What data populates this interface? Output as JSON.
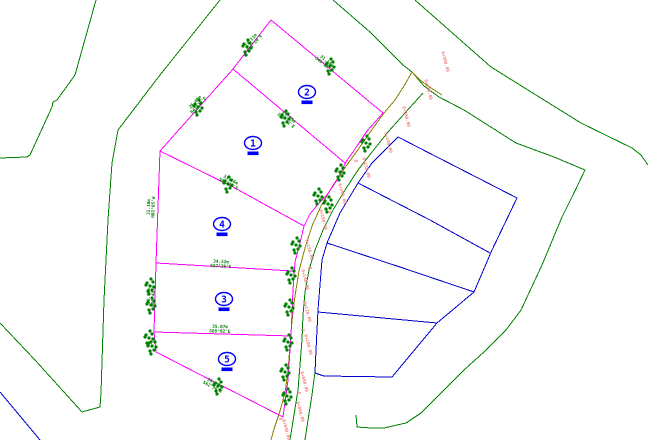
{
  "title": "subdivision-site-plan",
  "colors": {
    "boundary_green": "#008000",
    "parcel_magenta": "#FF00FF",
    "road_olive": "#8B8000",
    "block_blue": "#0000CD",
    "label_blue": "#0000FF",
    "station_red": "#F08080",
    "background": "#FFFFFF"
  },
  "parcel_labels": [
    {
      "number": "2",
      "x": 307,
      "y": 92
    },
    {
      "number": "1",
      "x": 253,
      "y": 143
    },
    {
      "number": "4",
      "x": 222,
      "y": 224
    },
    {
      "number": "3",
      "x": 224,
      "y": 299
    },
    {
      "number": "5",
      "x": 227,
      "y": 359
    }
  ],
  "drawing": {
    "polylines": [
      {
        "name": "contour-line-west",
        "color": "boundary_green",
        "width": 1,
        "points": [
          [
            96,
            0
          ],
          [
            75,
            75
          ],
          [
            57,
            100
          ],
          [
            53,
            102
          ],
          [
            52,
            107
          ],
          [
            30,
            155
          ],
          [
            27,
            157
          ],
          [
            0,
            158
          ]
        ]
      },
      {
        "name": "contour-line-inner",
        "color": "boundary_green",
        "width": 1,
        "points": [
          [
            220,
            0
          ],
          [
            160,
            75
          ],
          [
            118,
            130
          ],
          [
            112,
            163
          ],
          [
            108,
            220
          ],
          [
            104,
            300
          ],
          [
            101,
            393
          ],
          [
            100,
            407
          ],
          [
            82,
            412
          ]
        ]
      },
      {
        "name": "contour-line-southwest",
        "color": "boundary_green",
        "width": 1,
        "points": [
          [
            0,
            323
          ],
          [
            35,
            360
          ],
          [
            82,
            412
          ]
        ]
      },
      {
        "name": "boundary-line-northeast",
        "color": "boundary_green",
        "width": 1,
        "points": [
          [
            415,
            0
          ],
          [
            491,
            67
          ],
          [
            581,
            123
          ],
          [
            632,
            148
          ],
          [
            641,
            155
          ],
          [
            648,
            165
          ]
        ]
      },
      {
        "name": "road-east-boundary-curve",
        "color": "boundary_green",
        "width": 1,
        "points": [
          [
            333,
            0
          ],
          [
            370,
            32
          ],
          [
            403,
            65
          ],
          [
            412,
            72
          ],
          [
            424,
            86
          ],
          [
            439,
            97
          ],
          [
            464,
            110
          ],
          [
            516,
            143
          ],
          [
            554,
            157
          ],
          [
            585,
            170
          ],
          [
            572,
            197
          ],
          [
            562,
            217
          ],
          [
            542,
            265
          ],
          [
            521,
            310
          ],
          [
            506,
            330
          ],
          [
            484,
            352
          ],
          [
            464,
            370
          ],
          [
            441,
            393
          ],
          [
            421,
            413
          ],
          [
            406,
            423
          ],
          [
            384,
            428
          ],
          [
            371,
            428
          ],
          [
            357,
            427
          ],
          [
            356,
            415
          ]
        ]
      },
      {
        "name": "road-edge-green-inner",
        "color": "boundary_green",
        "width": 1,
        "points": [
          [
            423,
            93
          ],
          [
            405,
            113
          ],
          [
            388,
            132
          ],
          [
            372,
            152
          ],
          [
            358,
            170
          ],
          [
            345,
            190
          ],
          [
            333,
            210
          ],
          [
            323,
            230
          ],
          [
            315,
            250
          ],
          [
            309,
            270
          ],
          [
            305,
            292
          ],
          [
            303,
            315
          ],
          [
            302,
            340
          ],
          [
            300,
            365
          ],
          [
            298,
            390
          ],
          [
            294,
            415
          ],
          [
            290,
            440
          ]
        ]
      },
      {
        "name": "road-edge-green-lower",
        "color": "boundary_green",
        "width": 1,
        "points": [
          [
            315,
            372
          ],
          [
            312,
            395
          ],
          [
            308,
            420
          ],
          [
            305,
            440
          ]
        ]
      },
      {
        "name": "road-centerline",
        "color": "road_olive",
        "width": 1,
        "points": [
          [
            412,
            72
          ],
          [
            404,
            86
          ],
          [
            395,
            100
          ],
          [
            384,
            113
          ],
          [
            371,
            131
          ],
          [
            357,
            151
          ],
          [
            344,
            169
          ],
          [
            332,
            187
          ],
          [
            321,
            206
          ],
          [
            312,
            226
          ],
          [
            305,
            248
          ],
          [
            299,
            271
          ],
          [
            295,
            296
          ],
          [
            292,
            321
          ],
          [
            290,
            346
          ],
          [
            288,
            371
          ],
          [
            285,
            393
          ],
          [
            280,
            411
          ],
          [
            274,
            429
          ],
          [
            271,
            440
          ]
        ]
      },
      {
        "name": "road-centerline-branch",
        "color": "road_olive",
        "width": 1,
        "points": [
          [
            412,
            72
          ],
          [
            420,
            80
          ],
          [
            431,
            88
          ],
          [
            442,
            95
          ]
        ]
      },
      {
        "name": "parcel-outer-boundary",
        "color": "parcel_magenta",
        "width": 1,
        "points": [
          [
            271,
            20
          ],
          [
            233,
            69
          ],
          [
            160,
            151
          ],
          [
            156,
            263
          ],
          [
            154,
            332
          ],
          [
            156,
            352
          ],
          [
            283,
            417
          ],
          [
            288,
            380
          ],
          [
            291,
            335
          ],
          [
            293,
            290
          ],
          [
            295,
            262
          ],
          [
            300,
            243
          ],
          [
            304,
            226
          ],
          [
            310,
            214
          ],
          [
            318,
            204
          ],
          [
            327,
            195
          ],
          [
            337,
            180
          ],
          [
            346,
            162
          ],
          [
            357,
            146
          ],
          [
            367,
            131
          ],
          [
            383,
            113
          ],
          [
            271,
            20
          ]
        ]
      },
      {
        "name": "parcel-division-1-2",
        "color": "parcel_magenta",
        "width": 1,
        "points": [
          [
            233,
            69
          ],
          [
            289,
            116
          ],
          [
            345,
            163
          ]
        ]
      },
      {
        "name": "parcel-division-1-4",
        "color": "parcel_magenta",
        "width": 1,
        "points": [
          [
            160,
            151
          ],
          [
            233,
            187
          ],
          [
            304,
            226
          ]
        ]
      },
      {
        "name": "parcel-division-4-3",
        "color": "parcel_magenta",
        "width": 1,
        "points": [
          [
            156,
            263
          ],
          [
            293,
            271
          ]
        ]
      },
      {
        "name": "parcel-division-3-5",
        "color": "parcel_magenta",
        "width": 1,
        "points": [
          [
            154,
            332
          ],
          [
            291,
            336
          ]
        ]
      },
      {
        "name": "blue-block-outline",
        "color": "block_blue",
        "width": 1,
        "points": [
          [
            398,
            137
          ],
          [
            517,
            198
          ],
          [
            492,
            250
          ],
          [
            474,
            292
          ],
          [
            437,
            323
          ],
          [
            392,
            377
          ],
          [
            324,
            376
          ],
          [
            315,
            373
          ],
          [
            316,
            350
          ],
          [
            318,
            310
          ],
          [
            322,
            260
          ],
          [
            327,
            243
          ],
          [
            340,
            213
          ],
          [
            358,
            183
          ],
          [
            372,
            163
          ],
          [
            398,
            137
          ]
        ]
      },
      {
        "name": "blue-block-division-1",
        "color": "block_blue",
        "width": 1,
        "points": [
          [
            358,
            183
          ],
          [
            430,
            220
          ],
          [
            490,
            253
          ]
        ]
      },
      {
        "name": "blue-block-division-2",
        "color": "block_blue",
        "width": 1,
        "points": [
          [
            327,
            243
          ],
          [
            400,
            267
          ],
          [
            474,
            292
          ]
        ]
      },
      {
        "name": "blue-block-division-3",
        "color": "block_blue",
        "width": 1,
        "points": [
          [
            318,
            312
          ],
          [
            437,
            323
          ]
        ]
      },
      {
        "name": "blue-corner-line-southwest",
        "color": "block_blue",
        "width": 1,
        "points": [
          [
            0,
            392
          ],
          [
            40,
            440
          ]
        ]
      }
    ],
    "trees": [
      [
        247,
        47
      ],
      [
        198,
        107
      ],
      [
        285,
        118
      ],
      [
        330,
        66
      ],
      [
        366,
        143
      ],
      [
        340,
        172
      ],
      [
        228,
        184
      ],
      [
        318,
        196
      ],
      [
        328,
        204
      ],
      [
        296,
        245
      ],
      [
        291,
        275
      ],
      [
        289,
        307
      ],
      [
        288,
        342
      ],
      [
        285,
        372
      ],
      [
        287,
        396
      ],
      [
        150,
        286
      ],
      [
        151,
        305
      ],
      [
        149,
        338
      ],
      [
        152,
        346
      ],
      [
        218,
        386
      ]
    ],
    "dimension_labels": [
      {
        "x": 252,
        "y": 41,
        "rot": -50,
        "line1": "18.21m",
        "line2": "N42°10'E"
      },
      {
        "x": 196,
        "y": 103,
        "rot": -47,
        "line1": "26.40m",
        "line2": "N41°25'E"
      },
      {
        "x": 288,
        "y": 118,
        "rot": 40,
        "line1": "29.35m",
        "line2": "S50°12'E"
      },
      {
        "x": 326,
        "y": 62,
        "rot": 40,
        "line1": "31.10m",
        "line2": "S49°55'E"
      },
      {
        "x": 150,
        "y": 207,
        "rot": -88,
        "line1": "22.18m",
        "line2": "N02°05'W"
      },
      {
        "x": 150,
        "y": 296,
        "rot": -88,
        "line1": "20.65m",
        "line2": "N01°48'W"
      },
      {
        "x": 221,
        "y": 263,
        "rot": 3,
        "line1": "34.52m",
        "line2": "S87°30'E"
      },
      {
        "x": 220,
        "y": 328,
        "rot": 2,
        "line1": "35.07m",
        "line2": "S88°02'E"
      },
      {
        "x": 214,
        "y": 384,
        "rot": 27,
        "line1": "39.04m",
        "line2": "S62°30'E"
      },
      {
        "x": 230,
        "y": 181,
        "rot": 28,
        "line1": "33.86m",
        "line2": "S61°15'E"
      }
    ],
    "station_labels": [
      {
        "x": 444,
        "y": 62,
        "text": "0+300.00"
      },
      {
        "x": 427,
        "y": 90,
        "text": "0+280.00"
      },
      {
        "x": 405,
        "y": 117,
        "text": "0+260.00"
      },
      {
        "x": 387,
        "y": 143,
        "text": "0+240.00"
      },
      {
        "x": 365,
        "y": 168,
        "text": "0+220.00"
      },
      {
        "x": 341,
        "y": 194,
        "text": "0+200.00"
      },
      {
        "x": 322,
        "y": 220,
        "text": "0+180.00"
      },
      {
        "x": 308,
        "y": 250,
        "text": "0+160.00"
      },
      {
        "x": 304,
        "y": 280,
        "text": "0+140.00"
      },
      {
        "x": 306,
        "y": 312,
        "text": "0+120.00"
      },
      {
        "x": 307,
        "y": 345,
        "text": "0+100.00"
      },
      {
        "x": 303,
        "y": 382,
        "text": "0+080.00"
      },
      {
        "x": 299,
        "y": 412,
        "text": "0+060.00"
      },
      {
        "x": 285,
        "y": 430,
        "text": "0+040.00"
      }
    ],
    "ticks": [
      [
        356,
        161
      ],
      [
        330,
        212
      ],
      [
        310,
        268
      ],
      [
        303,
        330
      ],
      [
        299,
        393
      ],
      [
        281,
        419
      ]
    ]
  }
}
